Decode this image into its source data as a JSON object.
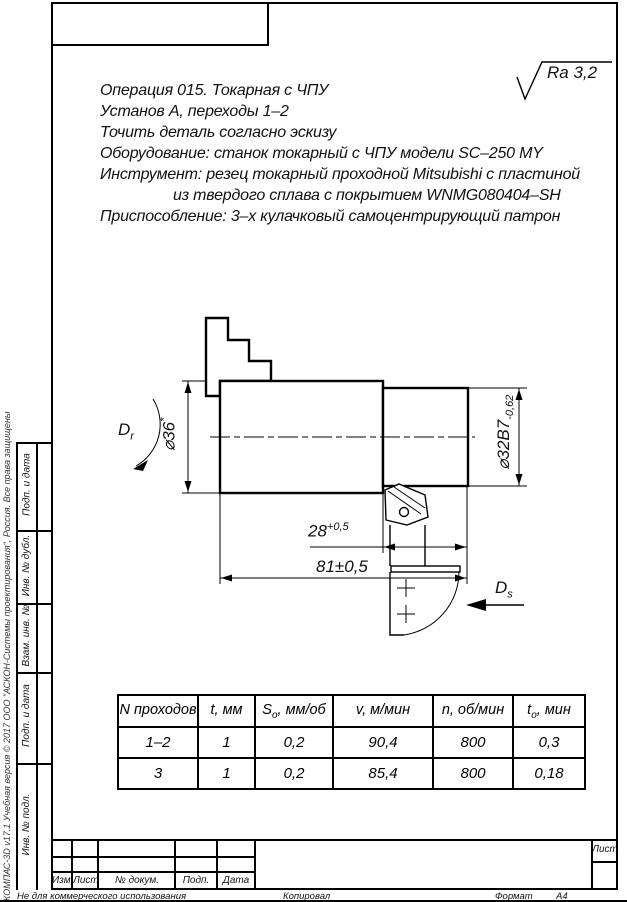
{
  "roughness_mark": {
    "text": "Ra 3,2"
  },
  "tech_requirements": {
    "lines": [
      "Операция 015. Токарная с ЧПУ",
      "Установ А, переходы 1–2",
      "Точить деталь согласно эскизу",
      "Оборудование: станок токарный с ЧПУ модели SC–250 MY",
      "Инструмент: резец токарный проходной Mitsubishi с пластиной",
      "из твердого сплава с покрытием WNMG080404–SH",
      "Приспособление: 3–х кулачковый самоцентрирующий патрон"
    ]
  },
  "sketch_labels": {
    "diameter_left": {
      "text": "⌀36",
      "suffix": "*"
    },
    "diameter_right": {
      "text": "⌀32B7",
      "tolerance_sub": "-0,62"
    },
    "length_inner": {
      "text": "28",
      "tolerance_sup": "+0,5"
    },
    "length_overall": {
      "text": "81±0,5"
    },
    "rotation_dir": {
      "letter": "D",
      "sub": "r"
    },
    "feed_dir": {
      "letter": "D",
      "sub": "s"
    }
  },
  "mode_table": {
    "headers": [
      {
        "pre": "N проходов",
        "sub": "",
        "post": ""
      },
      {
        "pre": "t, мм",
        "sub": "",
        "post": ""
      },
      {
        "pre": "S",
        "sub": "o",
        "post": ", мм/об"
      },
      {
        "pre": "v, м/мин",
        "sub": "",
        "post": ""
      },
      {
        "pre": "n, об/мин",
        "sub": "",
        "post": ""
      },
      {
        "pre": "t",
        "sub": "o",
        "post": ", мин"
      }
    ],
    "rows": [
      [
        "1–2",
        "1",
        "0,2",
        "90,4",
        "800",
        "0,3"
      ],
      [
        "3",
        "1",
        "0,2",
        "85,4",
        "800",
        "0,18"
      ]
    ]
  },
  "frame": {
    "side_labels": [
      "Подп. и дата",
      "Инв. № дубл.",
      "Взам. инв. №",
      "Подп. и дата",
      "Инв. № подл."
    ],
    "revision_labels": [
      "Изм.",
      "Лист",
      "№ докум.",
      "Подп.",
      "Дата"
    ],
    "sheet_cell_label": "Лист",
    "watermark": "КОМПАС-3D v17.1 Учебная версия © 2017 ООО \"АСКОН-Системы проектирования\", Россия. Все права защищены",
    "footer_left": "Не для коммерческого использования",
    "footer_center": "Копировал",
    "footer_format_label": "Формат",
    "footer_format_value": "А4"
  }
}
